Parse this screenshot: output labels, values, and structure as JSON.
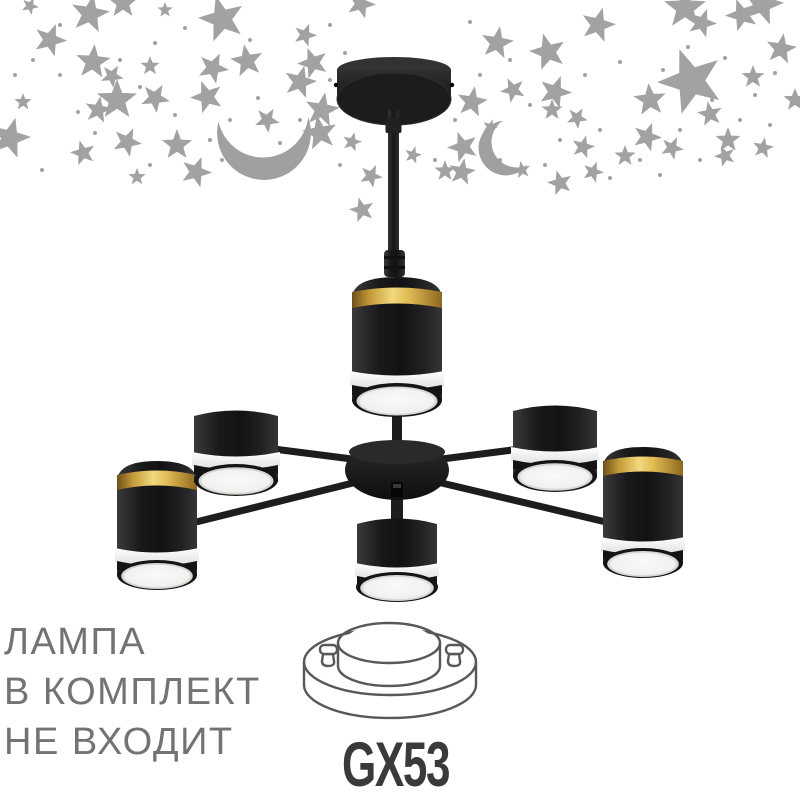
{
  "meta": {
    "description": "Product photo: 6-light black chandelier with gold rings on a white background with gray stars and crescent moons; lamp-not-included notice and GX53 socket diagram",
    "background_color": "#ffffff"
  },
  "notice": {
    "line1": "ЛАМПА",
    "line2": "В КОМПЛЕКТ",
    "line3": "НЕ ВХОДИТ",
    "color": "#737373"
  },
  "socket": {
    "label": "GX53",
    "color": "#3a3a3a"
  },
  "product": {
    "type": "ceiling chandelier",
    "lamp_heads": 6,
    "finish_color": "#1c1c1e",
    "accent_color": "#d9b04a",
    "diffuser_color": "#f2f1ef"
  },
  "colors": {
    "star_gray": "#a2a2a2",
    "moon_gray": "#a0a0a0",
    "diagram_line": "#57585a",
    "text_gray": "#737373"
  },
  "decor": {
    "stars": [
      [
        90,
        14,
        20,
        10
      ],
      [
        123,
        3,
        16,
        0
      ],
      [
        222,
        19,
        24,
        -15
      ],
      [
        50,
        40,
        17,
        20
      ],
      [
        93,
        62,
        18,
        5
      ],
      [
        112,
        76,
        12,
        30
      ],
      [
        150,
        66,
        10,
        0
      ],
      [
        213,
        68,
        16,
        25
      ],
      [
        247,
        61,
        17,
        -10
      ],
      [
        300,
        82,
        17,
        15
      ],
      [
        117,
        100,
        21,
        0
      ],
      [
        155,
        98,
        15,
        30
      ],
      [
        207,
        97,
        17,
        -20
      ],
      [
        98,
        110,
        14,
        10
      ],
      [
        23,
        102,
        9,
        0
      ],
      [
        10,
        138,
        21,
        15
      ],
      [
        83,
        153,
        13,
        -15
      ],
      [
        127,
        142,
        15,
        25
      ],
      [
        177,
        145,
        16,
        0
      ],
      [
        196,
        172,
        16,
        20
      ],
      [
        137,
        177,
        9,
        0
      ],
      [
        313,
        63,
        16,
        -20
      ],
      [
        322,
        110,
        18,
        10
      ],
      [
        267,
        120,
        13,
        30
      ],
      [
        361,
        4,
        15,
        20
      ],
      [
        320,
        133,
        18,
        -10
      ],
      [
        352,
        142,
        10,
        15
      ],
      [
        371,
        176,
        12,
        25
      ],
      [
        362,
        210,
        13,
        -15
      ],
      [
        497,
        43,
        17,
        10
      ],
      [
        548,
        52,
        19,
        -15
      ],
      [
        598,
        25,
        18,
        15
      ],
      [
        650,
        100,
        17,
        -5
      ],
      [
        685,
        8,
        22,
        0
      ],
      [
        742,
        15,
        17,
        -20
      ],
      [
        702,
        23,
        15,
        20
      ],
      [
        781,
        49,
        16,
        10
      ],
      [
        762,
        4,
        22,
        15
      ],
      [
        691,
        81,
        34,
        -20
      ],
      [
        753,
        77,
        12,
        0
      ],
      [
        555,
        92,
        17,
        20
      ],
      [
        513,
        90,
        13,
        -25
      ],
      [
        472,
        102,
        16,
        10
      ],
      [
        552,
        110,
        11,
        0
      ],
      [
        577,
        118,
        11,
        30
      ],
      [
        710,
        114,
        13,
        -10
      ],
      [
        647,
        137,
        15,
        20
      ],
      [
        728,
        140,
        13,
        0
      ],
      [
        463,
        147,
        16,
        -20
      ],
      [
        583,
        147,
        12,
        15
      ],
      [
        625,
        156,
        11,
        0
      ],
      [
        672,
        148,
        12,
        25
      ],
      [
        462,
        172,
        14,
        10
      ],
      [
        560,
        183,
        13,
        -15
      ],
      [
        593,
        172,
        11,
        20
      ],
      [
        445,
        171,
        11,
        0
      ],
      [
        413,
        155,
        9,
        15
      ],
      [
        725,
        156,
        11,
        -20
      ],
      [
        763,
        148,
        11,
        10
      ],
      [
        795,
        100,
        12,
        0
      ],
      [
        490,
        127,
        8,
        20
      ],
      [
        522,
        170,
        9,
        -10
      ],
      [
        30,
        6,
        9,
        25
      ],
      [
        165,
        10,
        8,
        0
      ],
      [
        305,
        35,
        12,
        20
      ],
      [
        365,
        95,
        9,
        0
      ]
    ],
    "dots": [
      [
        60,
        25,
        2
      ],
      [
        155,
        43,
        2
      ],
      [
        185,
        28,
        2
      ],
      [
        250,
        40,
        2
      ],
      [
        140,
        87,
        2
      ],
      [
        175,
        115,
        2
      ],
      [
        230,
        120,
        2
      ],
      [
        258,
        98,
        2
      ],
      [
        60,
        75,
        2
      ],
      [
        33,
        60,
        2
      ],
      [
        95,
        133,
        2
      ],
      [
        150,
        165,
        2
      ],
      [
        222,
        160,
        2
      ],
      [
        280,
        143,
        2
      ],
      [
        330,
        80,
        2
      ],
      [
        345,
        53,
        2
      ],
      [
        300,
        120,
        2
      ],
      [
        330,
        25,
        2
      ],
      [
        470,
        22,
        2
      ],
      [
        510,
        60,
        2
      ],
      [
        585,
        75,
        2
      ],
      [
        620,
        62,
        2
      ],
      [
        663,
        70,
        2
      ],
      [
        688,
        47,
        2
      ],
      [
        725,
        58,
        2
      ],
      [
        755,
        95,
        2
      ],
      [
        775,
        73,
        2
      ],
      [
        712,
        100,
        2
      ],
      [
        680,
        130,
        2
      ],
      [
        640,
        160,
        2
      ],
      [
        600,
        130,
        2
      ],
      [
        560,
        140,
        2
      ],
      [
        530,
        105,
        2
      ],
      [
        480,
        75,
        2
      ],
      [
        455,
        120,
        2
      ],
      [
        435,
        160,
        2
      ],
      [
        500,
        160,
        2
      ],
      [
        545,
        165,
        2
      ],
      [
        610,
        178,
        2
      ],
      [
        660,
        175,
        2
      ],
      [
        700,
        160,
        2
      ],
      [
        740,
        120,
        2
      ],
      [
        770,
        125,
        2
      ],
      [
        300,
        150,
        2
      ],
      [
        340,
        165,
        2
      ],
      [
        265,
        178,
        2
      ],
      [
        210,
        140,
        2
      ],
      [
        120,
        60,
        2
      ],
      [
        78,
        112,
        2
      ],
      [
        42,
        170,
        2
      ],
      [
        15,
        75,
        2
      ]
    ],
    "moons": [
      {
        "cx": 264,
        "cy": 133,
        "r": 47,
        "icx": 263,
        "icy": 112,
        "ir": 45.5
      },
      {
        "cx": 506,
        "cy": 148,
        "r": 27.5,
        "icx": 517,
        "icy": 142,
        "ir": 25.5
      }
    ]
  }
}
